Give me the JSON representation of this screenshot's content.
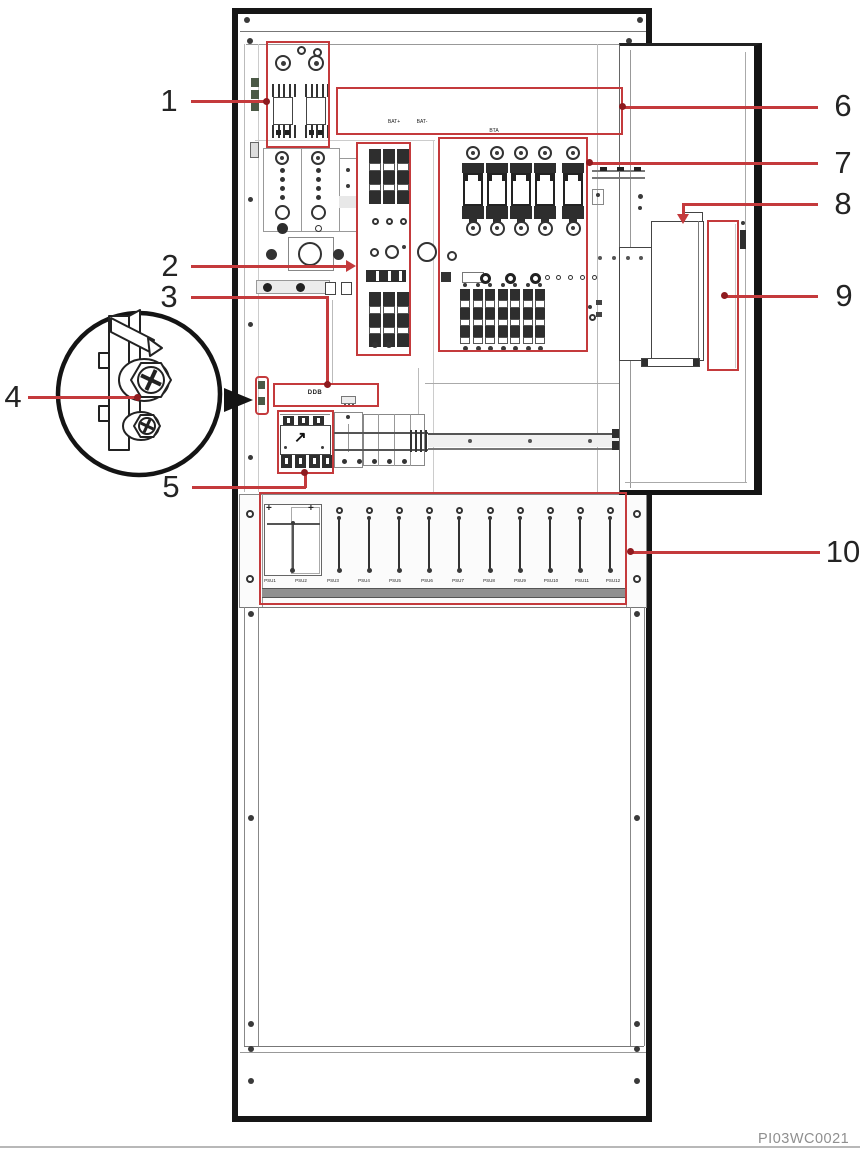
{
  "figure": {
    "type": "power-cabinet-component-illustration",
    "watermark": "PI03WC0021"
  },
  "callouts": [
    "1",
    "2",
    "3",
    "4",
    "5",
    "6",
    "7",
    "8",
    "9",
    "10"
  ],
  "labels": {
    "battery_terminal_left": "BAT+",
    "battery_terminal_right": "BAT-",
    "busbar": "BTA",
    "distribution_strip": "DDB"
  },
  "psu_shelf": {
    "slot_labels": [
      "PSU1",
      "PSU2",
      "PSU3",
      "PSU4",
      "PSU5",
      "PSU6",
      "PSU7",
      "PSU8",
      "PSU9",
      "PSU10",
      "PSU11",
      "PSU12"
    ]
  },
  "icons": {
    "contactor_arrow": "↗",
    "phillips_screw": "+"
  },
  "colors": {
    "annotation_red": "#c43a3c",
    "leader_dot_red": "#8e1b1f",
    "line_art": "#3a3a3a",
    "watermark_gray": "#8f8f8f"
  }
}
